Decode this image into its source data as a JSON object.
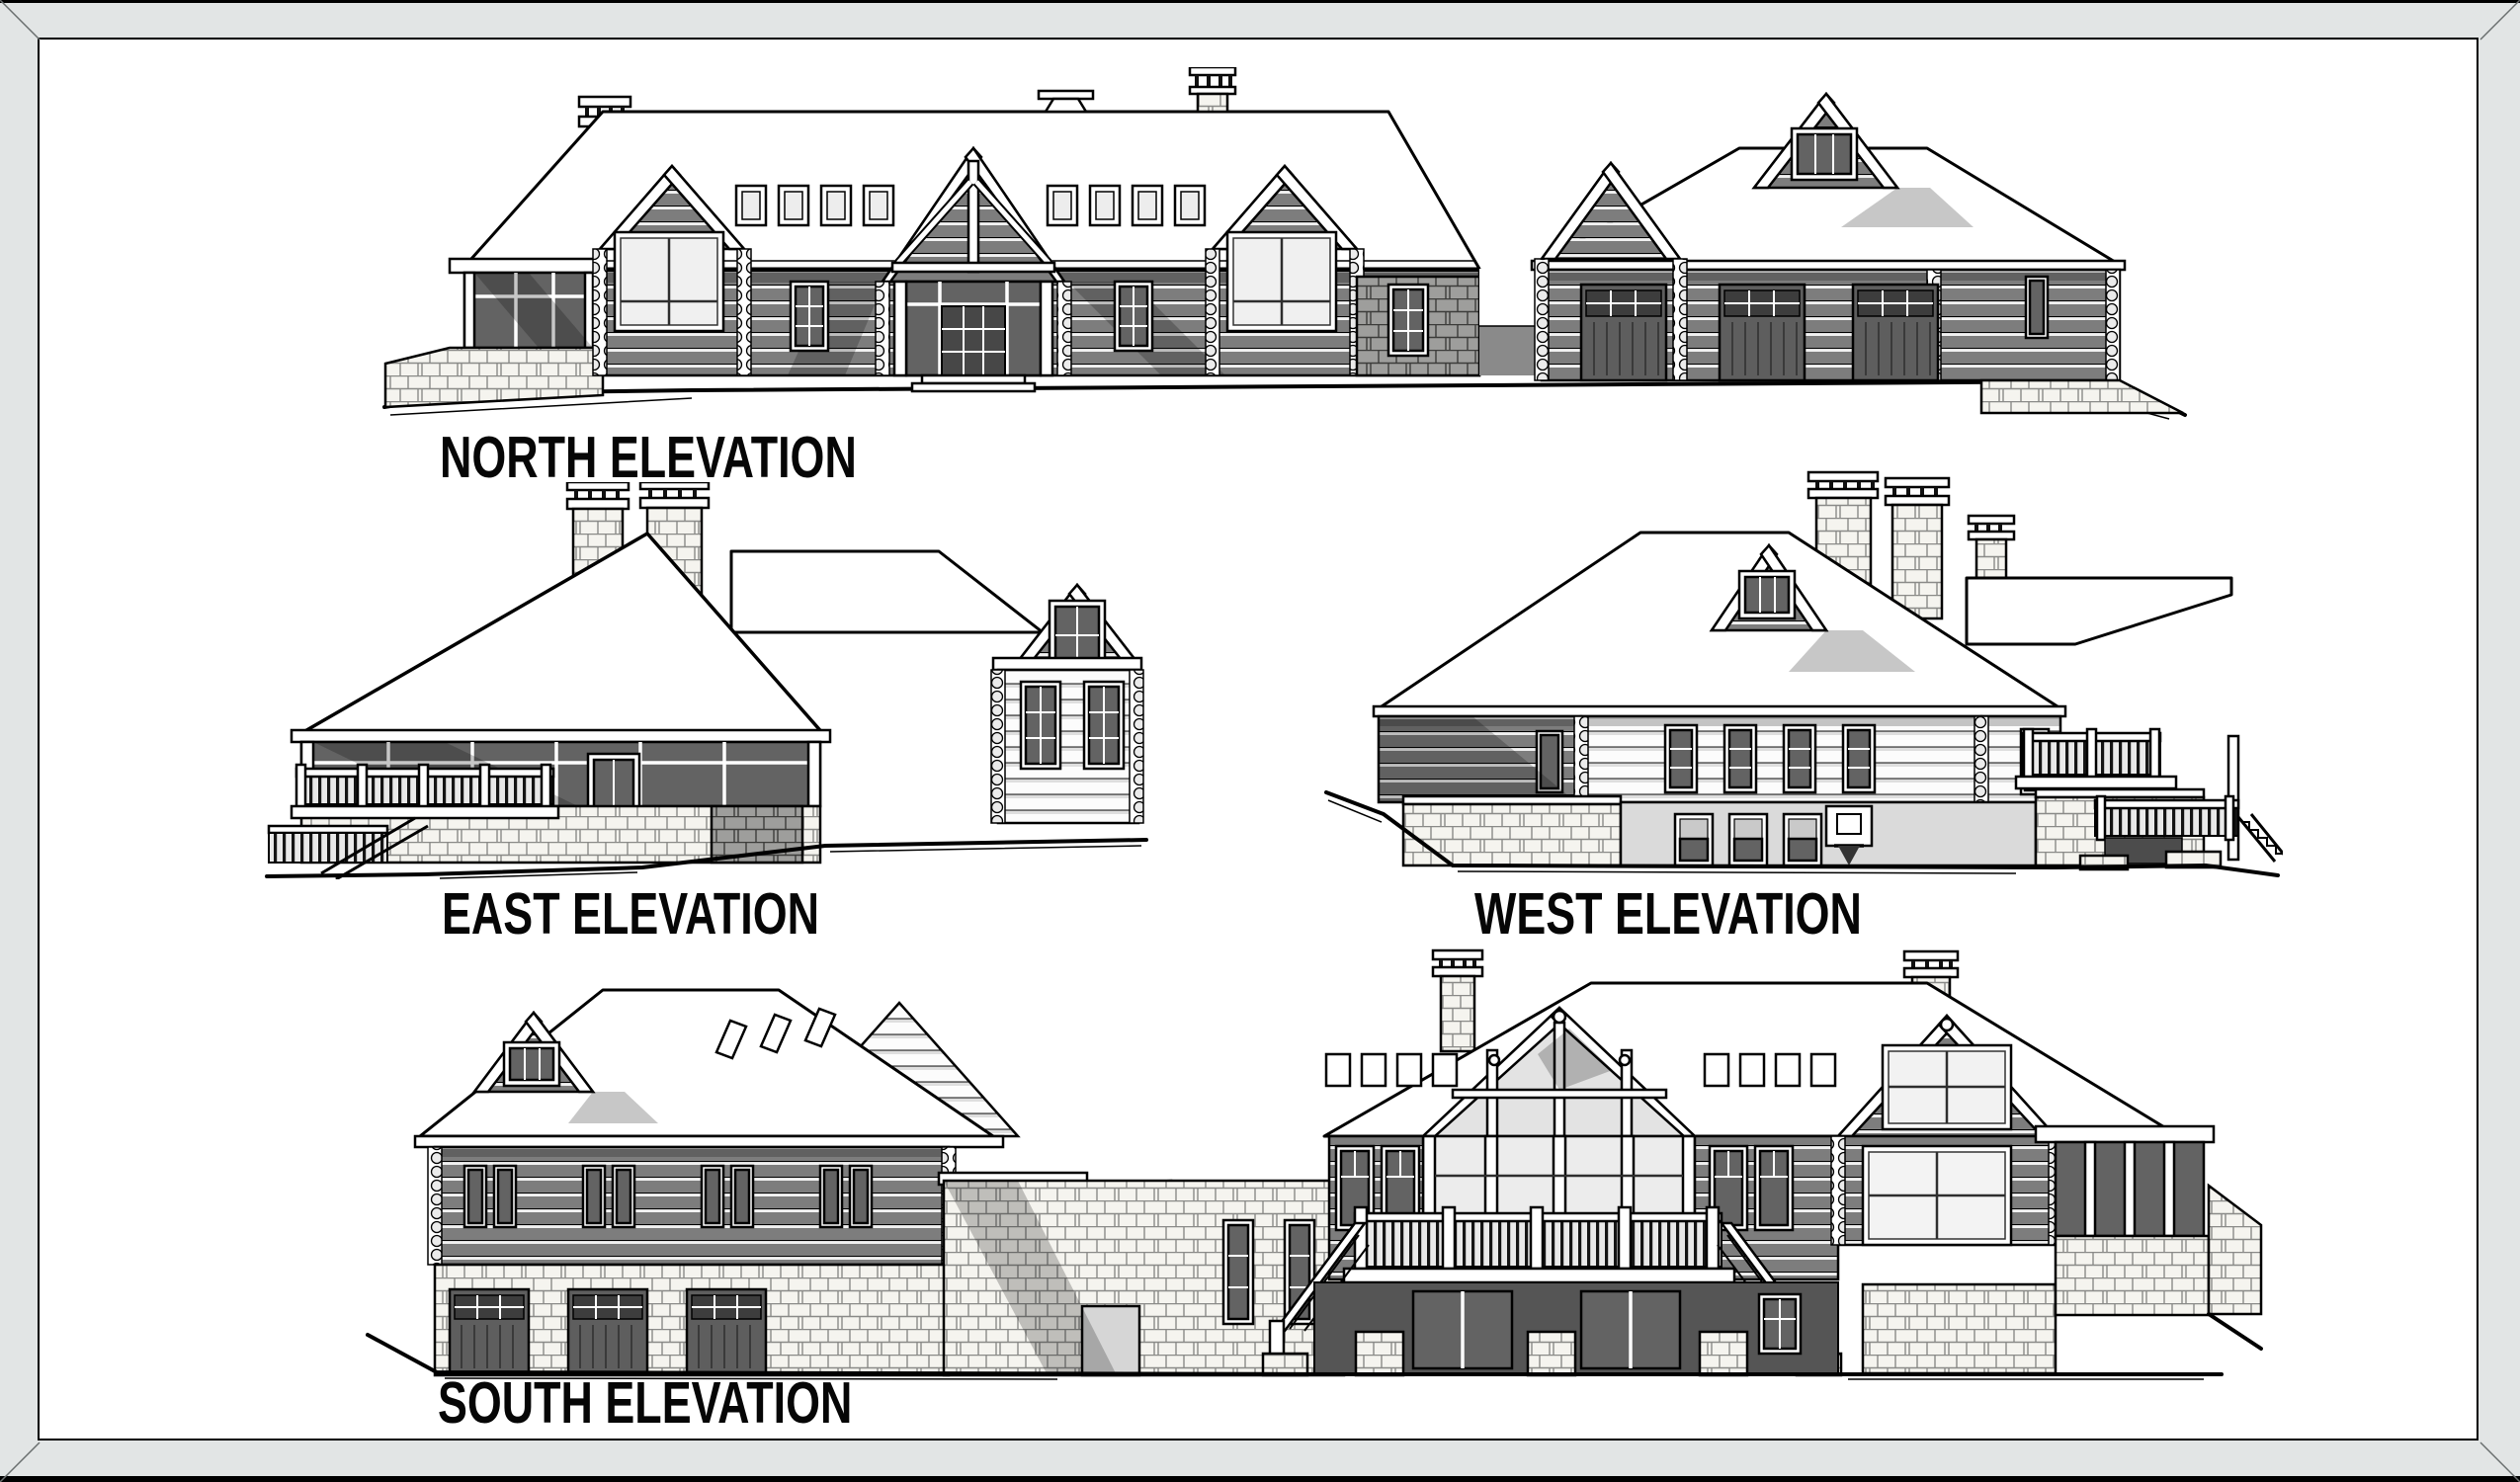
{
  "sheet": {
    "kind": "architectural elevation drawing set",
    "subject": "log home exterior elevations",
    "paper_color": "#ffffff",
    "frame_color": "#e2e5e5",
    "ink_color": "#000000",
    "shade_color": "#7d7d7d"
  },
  "elevations": [
    {
      "id": "north",
      "label": "NORTH ELEVATION",
      "features": [
        "long gable roof with ridge vent and capped chimney",
        "stone chimney at left",
        "three front gables with log faces",
        "central entry gable with white truss and glazed entry",
        "two bands of four clerestory windows",
        "screened porch at left on stone base",
        "stone wall section with window",
        "garage wing with hip roof and gable dormer",
        "three garage doors",
        "grade sloping down at both ends"
      ]
    },
    {
      "id": "east",
      "label": "EAST ELEVATION",
      "features": [
        "pyramidal hip roof over glazed porch",
        "twin stone chimneys with railed caps",
        "stone knee wall and base",
        "elevated deck with railing and lower stair at left",
        "rear house gable with tall window",
        "log walls with gridded windows",
        "grade falling to the left"
      ]
    },
    {
      "id": "west",
      "label": "WEST ELEVATION",
      "features": [
        "large hip roof with gable dormer",
        "two capped stone chimneys and roof cap",
        "log upper walls with band of four windows",
        "lower-level sport wall with basketball hoop",
        "three lower windows",
        "stone retaining walls",
        "two-level deck with stairs at right",
        "grade falling from left mound"
      ]
    },
    {
      "id": "south",
      "label": "SOUTH ELEVATION",
      "features": [
        "garage wing hip roof with gable dormer and three skylights",
        "log upper wall with four paired windows",
        "stone lower level with three garage doors",
        "basketball backboard and hoop",
        "central stone block with utility door",
        "glass prow gable at center of main house",
        "clerestory window bands",
        "full-width deck with balustrade and twin outward stairs",
        "walkout lower level with glass doors",
        "right gable with large window",
        "screened porch wing at right",
        "capped chimneys"
      ]
    }
  ]
}
